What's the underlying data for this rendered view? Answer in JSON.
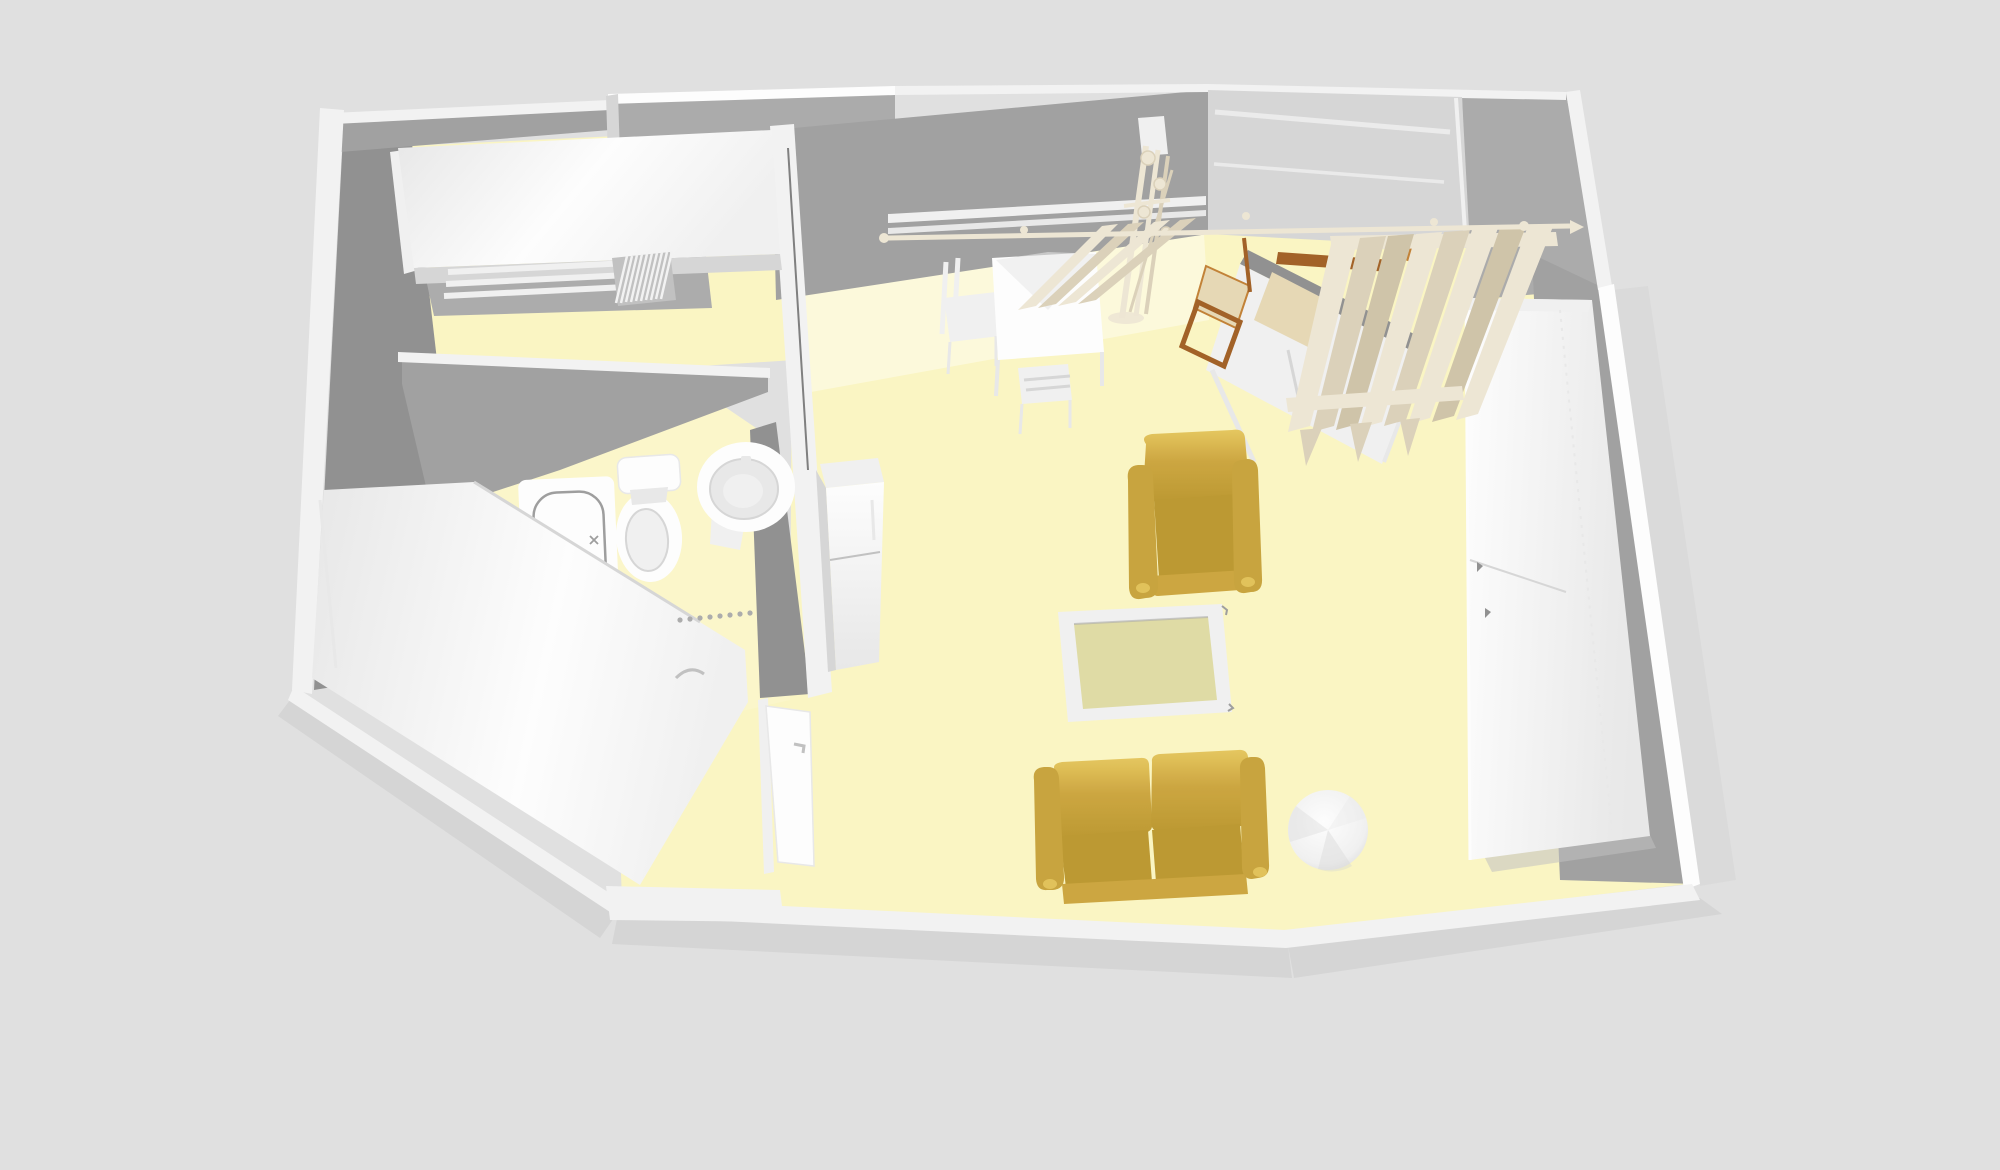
{
  "view": {
    "label": "3D aerial view of studio apartment floor plan",
    "width": 2000,
    "height": 1170
  },
  "colors": {
    "background": "#e1e1e1",
    "shadow": "#c9c9c9",
    "shadowSoft": "#d6d6d6",
    "wallTop": "#f4f4f4",
    "wallTopBright": "#ffffff",
    "wallFace": "#9d9d9d",
    "wallFaceDark": "#8d8d8d",
    "wallFaceLight": "#a9a9a9",
    "windowLight": "#d6d6d6",
    "floor": "#fcf7c2",
    "floorLight": "#fefbdb",
    "floorBright": "#fdf8c9",
    "white": "#ffffff",
    "offWhite": "#f2f2f2",
    "softWhite": "#e9e9e9",
    "grayLine": "#bfbfbf",
    "midGray": "#aaaaaa",
    "darkLine": "#7a7a7a",
    "fixtureStroke": "#9a9a9a",
    "gold": "#cca337",
    "goldLight": "#e6c658",
    "goldDark": "#a98526",
    "goldSeat": "#ba9529",
    "goldArm": "#c7a135",
    "glassTop": "#dfdba2",
    "wood": "#9e5a1c",
    "woodLight": "#c07c2e",
    "cream": "#efe7d4",
    "creamShadow": "#dbd1b8",
    "creamDark": "#cfc3a6",
    "tan": "#e7d8b3"
  },
  "scene": {
    "rooms": [
      {
        "name": "bedroom"
      },
      {
        "name": "bathroom"
      },
      {
        "name": "kitchen"
      },
      {
        "name": "entry-hall"
      },
      {
        "name": "living-room"
      },
      {
        "name": "dressing-area"
      }
    ],
    "furniture": [
      {
        "id": "bed",
        "label": "Double bed with white cover"
      },
      {
        "id": "radiator",
        "label": "Radiator"
      },
      {
        "id": "bathtub",
        "label": "Bathtub"
      },
      {
        "id": "toilet",
        "label": "Toilet"
      },
      {
        "id": "pedestal-sink",
        "label": "Pedestal washbasin"
      },
      {
        "id": "kitchen-counter",
        "label": "Kitchen counter unit"
      },
      {
        "id": "refrigerator",
        "label": "Refrigerator"
      },
      {
        "id": "entry-door",
        "label": "Entry door"
      },
      {
        "id": "dining-table",
        "label": "Square dining table"
      },
      {
        "id": "dining-chair-left",
        "label": "Dining chair (left)"
      },
      {
        "id": "dining-chair-front",
        "label": "Dining chair (front)"
      },
      {
        "id": "coat-stand",
        "label": "Coat stand"
      },
      {
        "id": "desk",
        "label": "Desk"
      },
      {
        "id": "desk-chair",
        "label": "Wooden chair with cushion"
      },
      {
        "id": "window",
        "label": "Window"
      },
      {
        "id": "curtains",
        "label": "Curtains"
      },
      {
        "id": "curtain-rod",
        "label": "Curtain rod"
      },
      {
        "id": "wardrobe",
        "label": "Tall white wardrobe"
      },
      {
        "id": "armchair",
        "label": "Gold armchair"
      },
      {
        "id": "coffee-table",
        "label": "Glass-top coffee table"
      },
      {
        "id": "loveseat-sofa",
        "label": "Gold loveseat sofa"
      },
      {
        "id": "round-side-table",
        "label": "Round pedestal table"
      }
    ]
  }
}
